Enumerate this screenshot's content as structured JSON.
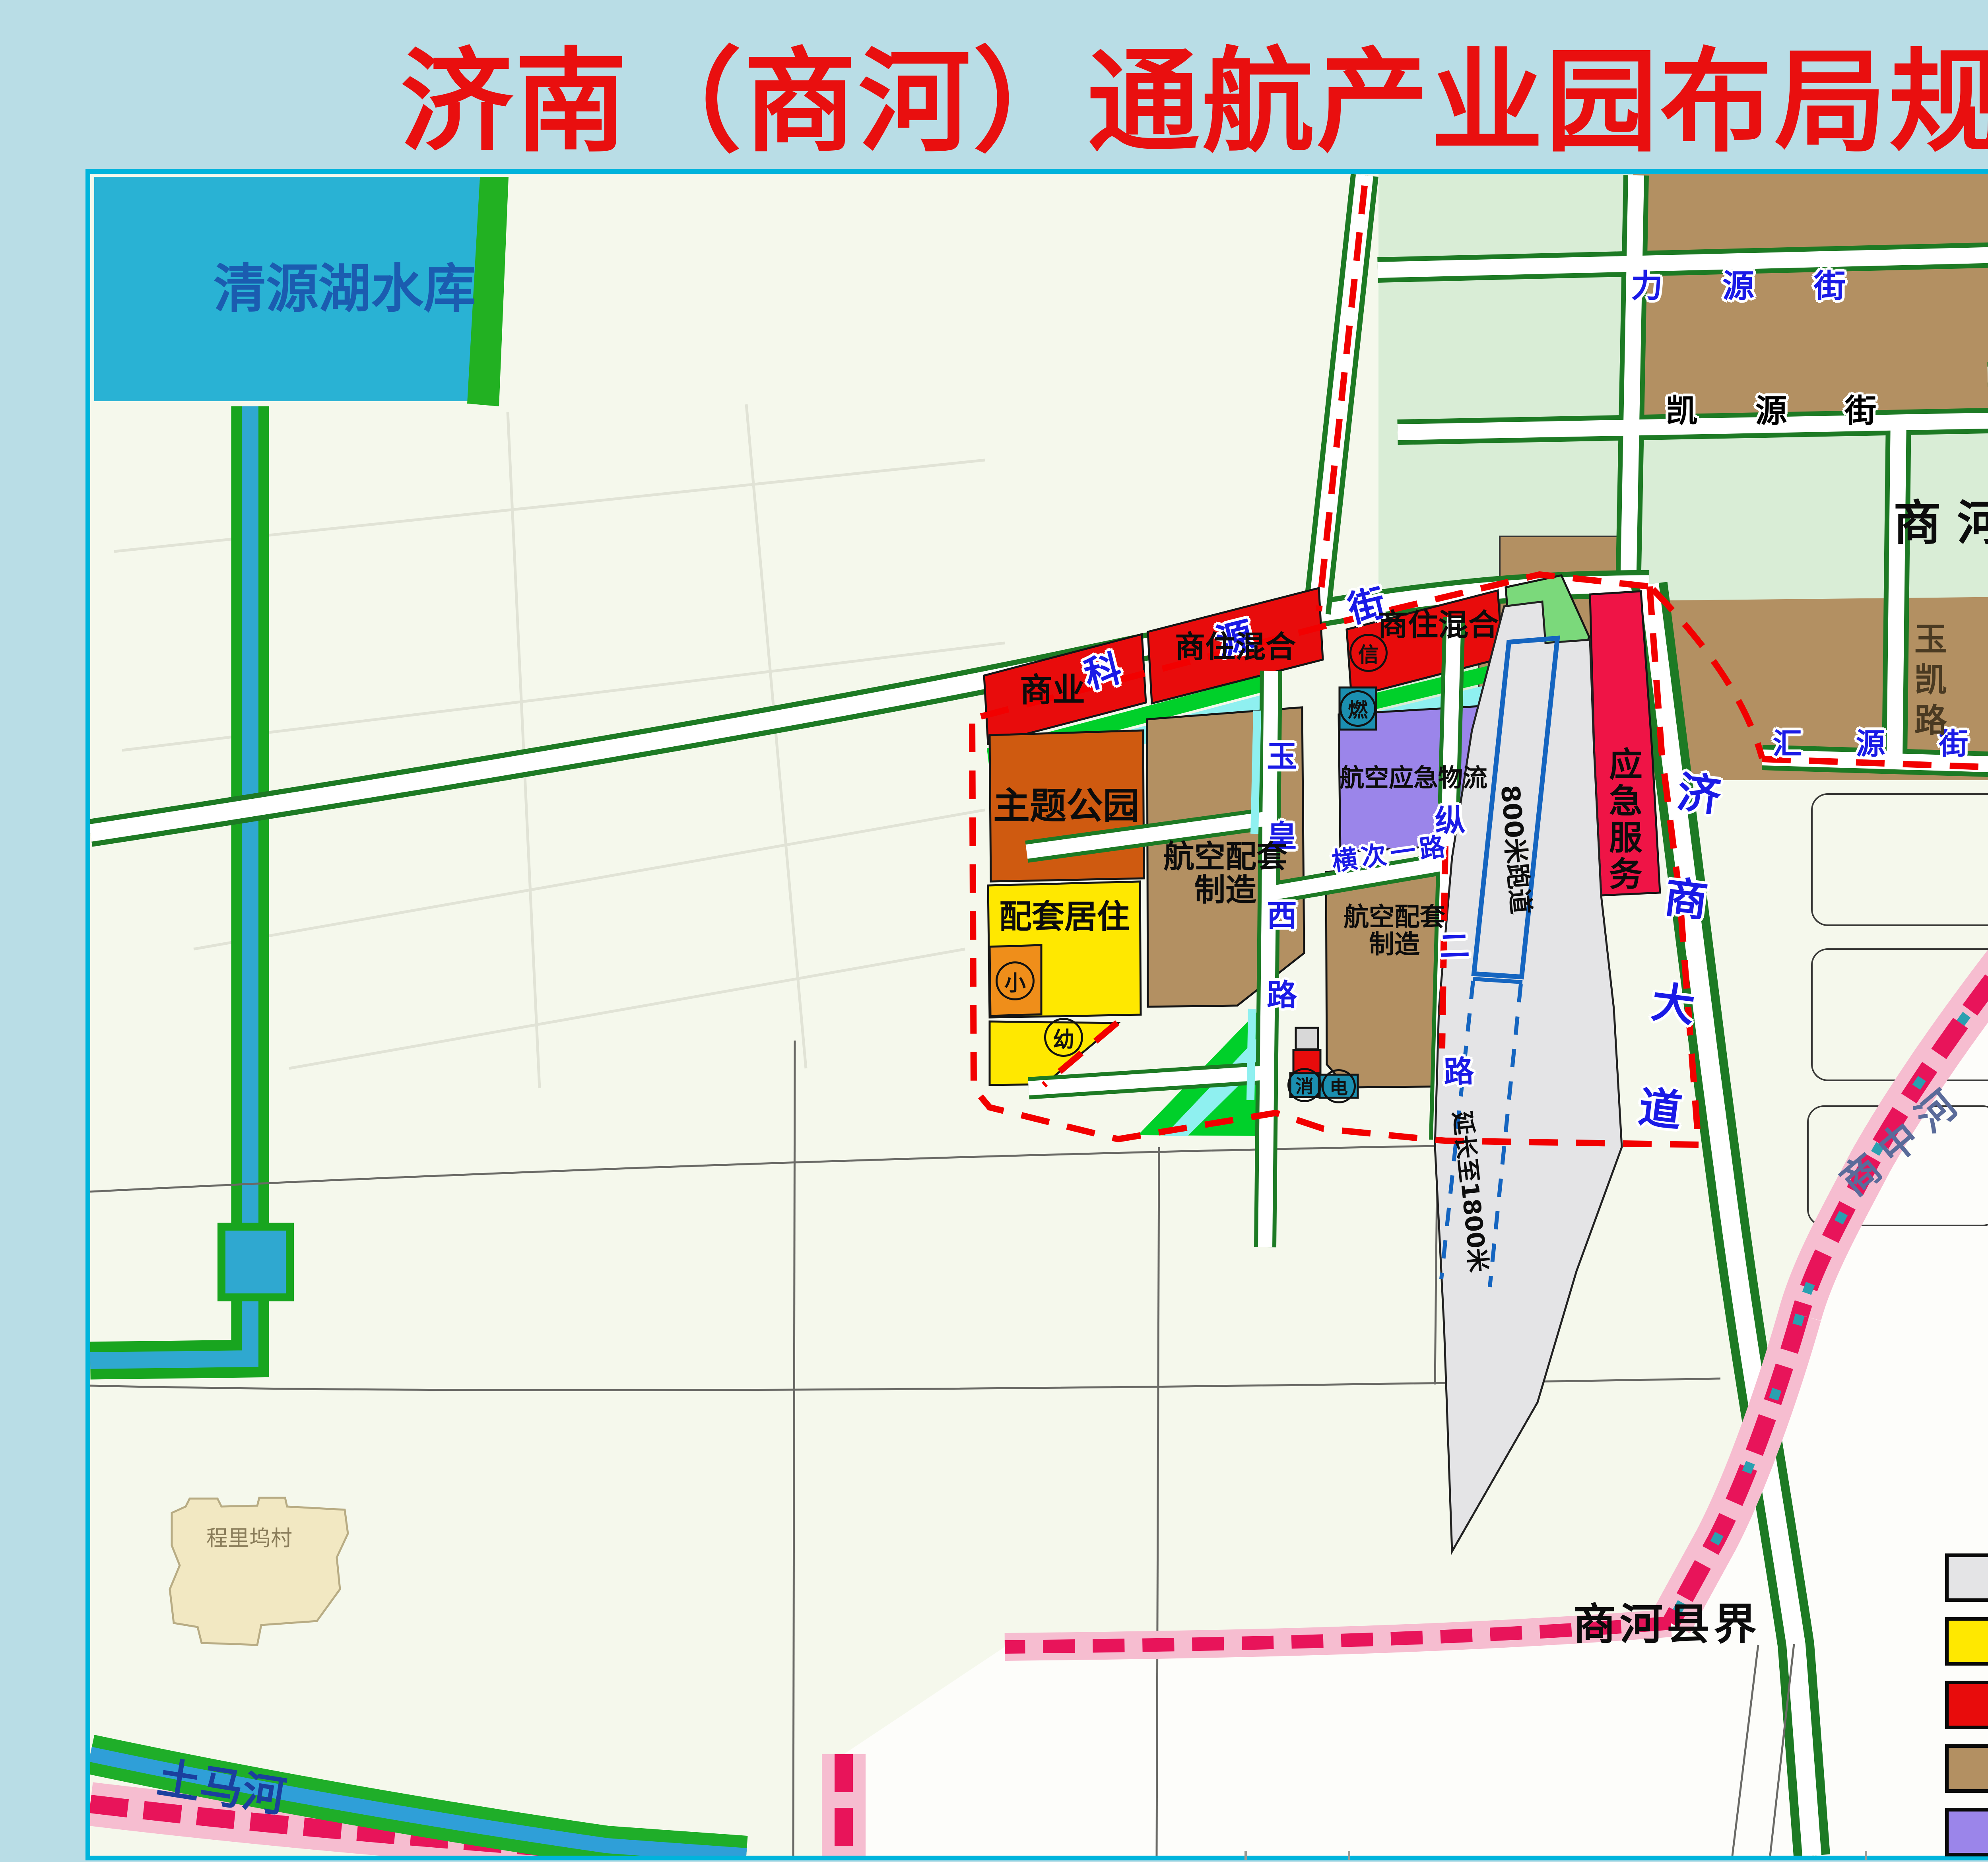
{
  "title": "济南（商河）通航产业园布局规划图",
  "colors": {
    "title_red": "#e90f0f",
    "page_bg": "#b9dde6",
    "map_frame": "#00b4dc",
    "airport": "#e4e4e6",
    "residential": "#ffe800",
    "commercial": "#e80c0c",
    "industrial": "#b39062",
    "logistics": "#9b85ea",
    "service_crimson": "#ef1446",
    "theme_park": "#cf5a10",
    "school_orange": "#ef8e1a",
    "park_green": "#7bd97b",
    "strip_green": "#00d02a",
    "light_parcel": "#d9edd6",
    "water": "#29b2d4",
    "cyan_strip": "#8ff0f0",
    "teal_utility": "#1b8fb0",
    "road_green": "#1d7a24",
    "boundary_red": "#f20000",
    "county_crimson": "#e8145a",
    "county_pink": "#f6bdd0",
    "blue_parcel": "#3f77c2",
    "runway_blue": "#1565c0",
    "label_blue": "#1a1ae6",
    "river_label_blue": "#1b3f9e",
    "reservoir_label": "#1b5cb0"
  },
  "labels": {
    "water": {
      "qingyuan": "清源湖水库",
      "tuma": "土马河",
      "shangzhong": "商中河"
    },
    "roads": {
      "keyuan": "科源街",
      "liyuan": "力源街",
      "kaiyuan": "凯源街",
      "huiyuan": "汇源街",
      "yukai": "玉凯路",
      "daling": "大岭路",
      "jishang": "济商大道",
      "yuhuangxi": "玉皇西路",
      "hengci": "横次一路",
      "zonger": "纵二路"
    },
    "areas": {
      "kaifaqu": "商河经济开发区",
      "xianjie": "商河县界",
      "village": "程里坞村"
    },
    "zones": {
      "shangye": "商业",
      "shangzhu": "商住混合",
      "zhuti": "主题公园",
      "hangkong_peitao": "航空配套制造",
      "peitao_juzhu": "配套居住",
      "hangkong_yingji": "航空应急物流",
      "yingji_fuwu": "应急服务"
    },
    "icons": {
      "xin": "信",
      "ran": "燃",
      "xiao": "小",
      "you": "幼",
      "xiaofang": "消",
      "dian": "电"
    },
    "runway": {
      "r800": "800米跑道",
      "extension": "延长至1800米"
    }
  },
  "legend": {
    "title": "图例",
    "items": [
      {
        "label": "机场用地",
        "color": "#e4e4e6"
      },
      {
        "label": "居住用地",
        "color": "#ffe800"
      },
      {
        "label": "商业服务业设施用地",
        "color": "#e80c0c"
      },
      {
        "label": "工业用地",
        "color": "#b39062"
      },
      {
        "label": "物流用地",
        "color": "#9b85ea"
      }
    ]
  }
}
